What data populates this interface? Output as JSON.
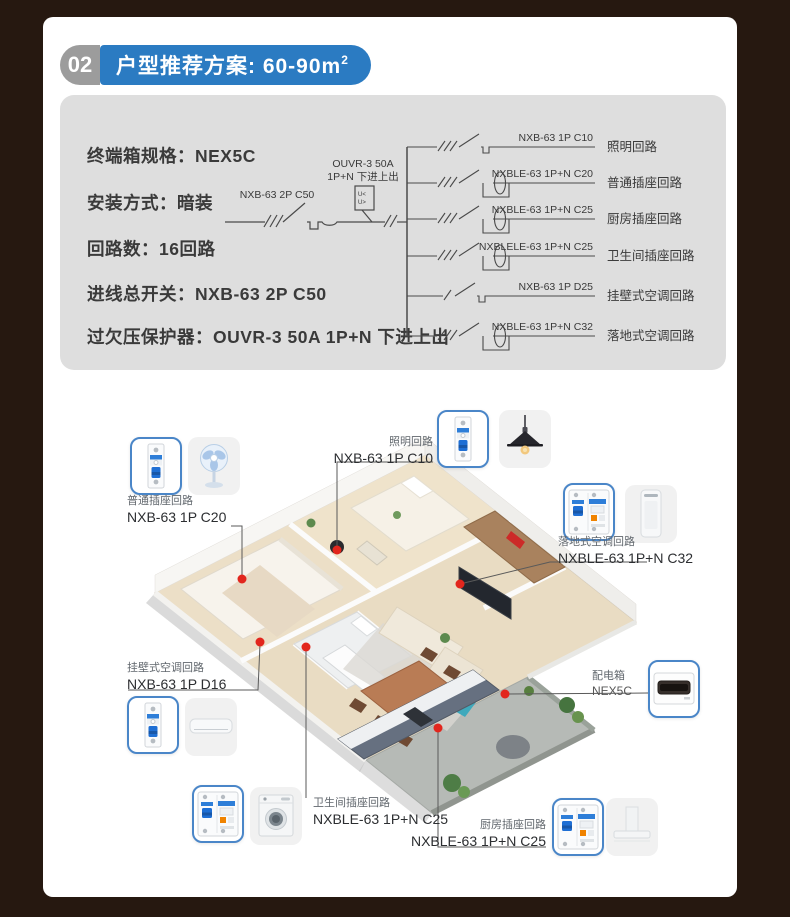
{
  "colors": {
    "background": "#261810",
    "accent_blue": "#2b7bc2",
    "badge_gray": "#9c9c9c",
    "panel_gray": "#dedede",
    "callout_border": "#4a86c8",
    "dot_red": "#e2261d"
  },
  "header": {
    "number": "02",
    "title": "户型推荐方案: 60-90m",
    "title_sup": "2"
  },
  "specs": {
    "lines": [
      "终端箱规格：NEX5C",
      "安装方式：暗装",
      "回路数：16回路",
      "进线总开关：NXB-63 2P C50",
      "过欠压保护器：OUVR-3 50A 1P+N 下进上出"
    ]
  },
  "diagram": {
    "main_breaker_label": "NXB-63 2P C50",
    "protector_label_line1": "OUVR-3 50A",
    "protector_label_line2": "1P+N 下进上出",
    "protector_box_top": "U<",
    "protector_box_bottom": "U>",
    "branches": [
      {
        "model": "NXB-63 1P C10",
        "name": "照明回路"
      },
      {
        "model": "NXBLE-63 1P+N C20",
        "name": "普通插座回路"
      },
      {
        "model": "NXBLE-63 1P+N C25",
        "name": "厨房插座回路"
      },
      {
        "model": "NXBLELE-63 1P+N C25",
        "name": "卫生间插座回路"
      },
      {
        "model": "NXB-63 1P D25",
        "name": "挂壁式空调回路"
      },
      {
        "model": "NXBLE-63 1P+N C32",
        "name": "落地式空调回路"
      }
    ]
  },
  "floorplan": {
    "callouts": [
      {
        "name": "普通插座回路",
        "model": "NXB-63 1P C20",
        "device": "standing-fan"
      },
      {
        "name": "照明回路",
        "model": "NXB-63 1P C10",
        "device": "pendant-lamp"
      },
      {
        "name": "落地式空调回路",
        "model": "NXBLE-63 1P+N C32",
        "device": "floor-ac"
      },
      {
        "name": "挂壁式空调回路",
        "model": "NXB-63 1P D16",
        "device": "wall-ac"
      },
      {
        "name": "配电箱",
        "model": "NEX5C",
        "device": "distribution-box"
      },
      {
        "name": "卫生间插座回路",
        "model": "NXBLE-63 1P+N C25",
        "device": "washing-machine"
      },
      {
        "name": "厨房插座回路",
        "model": "NXBLE-63 1P+N C25",
        "device": "range-hood"
      }
    ]
  }
}
